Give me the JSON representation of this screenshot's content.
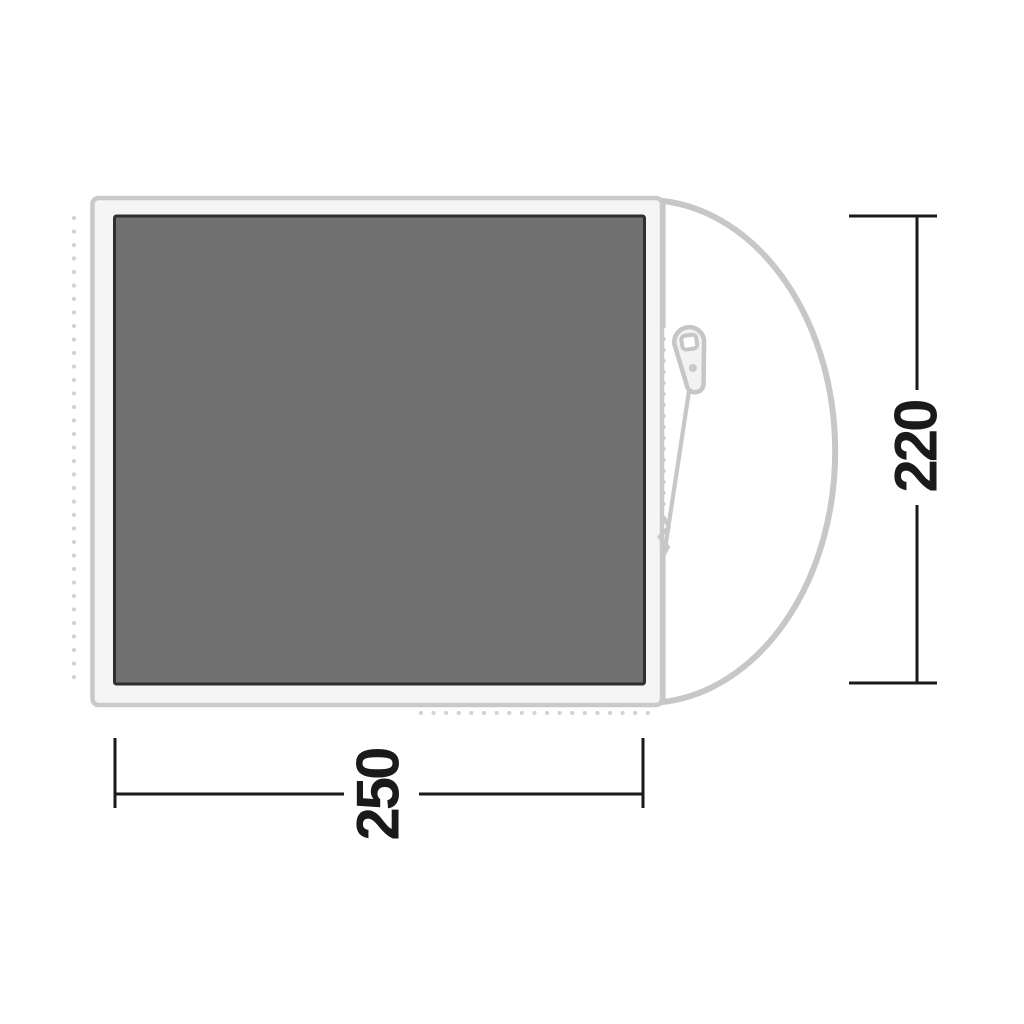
{
  "diagram": {
    "type": "tent-footprint-floorplan-top-view",
    "description": "Product diagram of a tent footprint / groundsheet seen from above with a D-shaped door on the right side and a zipper",
    "dimensions": {
      "width_label": "250",
      "height_label": "220"
    },
    "icons": [
      "zipper-pull-icon"
    ],
    "colors": {
      "background": "#ffffff",
      "floor_fill": "#707070",
      "floor_border": "#2f2f2f",
      "groundsheet_fill": "#f5f5f5",
      "outline_gray": "#c7c7c7",
      "dotted_gray": "#d2d2d2",
      "dimension_black": "#1a1a1a"
    }
  }
}
